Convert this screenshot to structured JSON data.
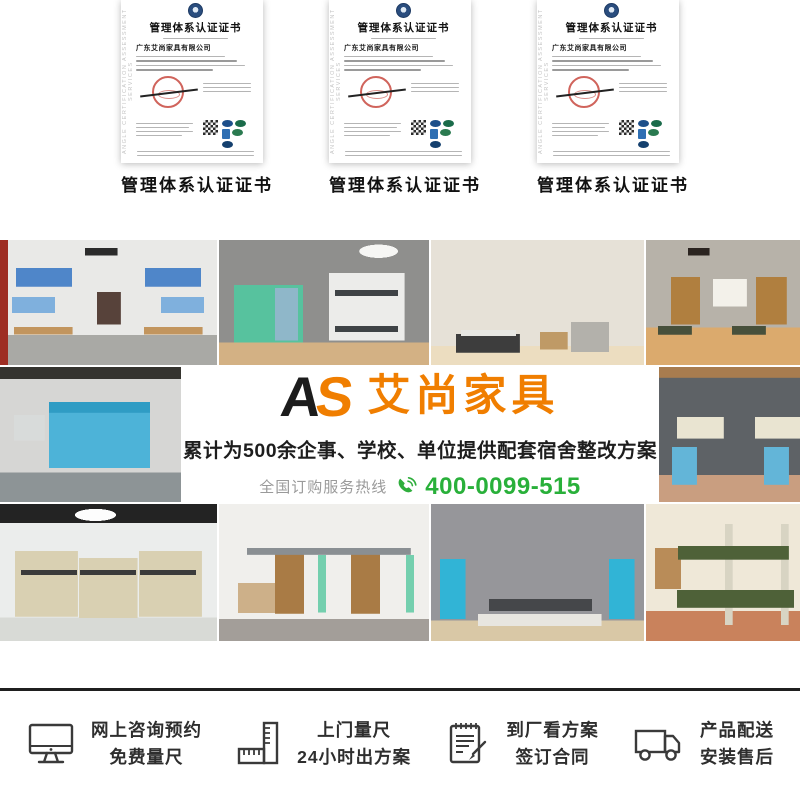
{
  "colors": {
    "brand_orange": "#f07e00",
    "logo_black": "#1c1c1c",
    "hotline_green": "#29b03a",
    "divider_dark": "#1f1f1f",
    "cert_stamp_red": "#c0392b"
  },
  "certificates": {
    "caption": "管理体系认证证书",
    "title": "管理体系认证证书",
    "company": "广东艾尚家具有限公司",
    "watermark": "ANGLE CERTIFICATION ASSESSMENT SERVICES"
  },
  "banner": {
    "logo_a": "A",
    "logo_s": "S",
    "logo_name": "艾尚家具",
    "headline": "累计为500余企事、学校、单位提供配套宿舍整改方案",
    "hotline_label": "全国订购服务热线",
    "hotline_number": "400-0099-515"
  },
  "services": {
    "items": [
      {
        "icon": "monitor-icon",
        "line1": "网上咨询预约",
        "line2": "免费量尺"
      },
      {
        "icon": "ruler-icon",
        "line1": "上门量尺",
        "line2": "24小时出方案"
      },
      {
        "icon": "contract-icon",
        "line1": "到厂看方案",
        "line2": "签订合同"
      },
      {
        "icon": "truck-icon",
        "line1": "产品配送",
        "line2": "安装售后"
      }
    ]
  }
}
